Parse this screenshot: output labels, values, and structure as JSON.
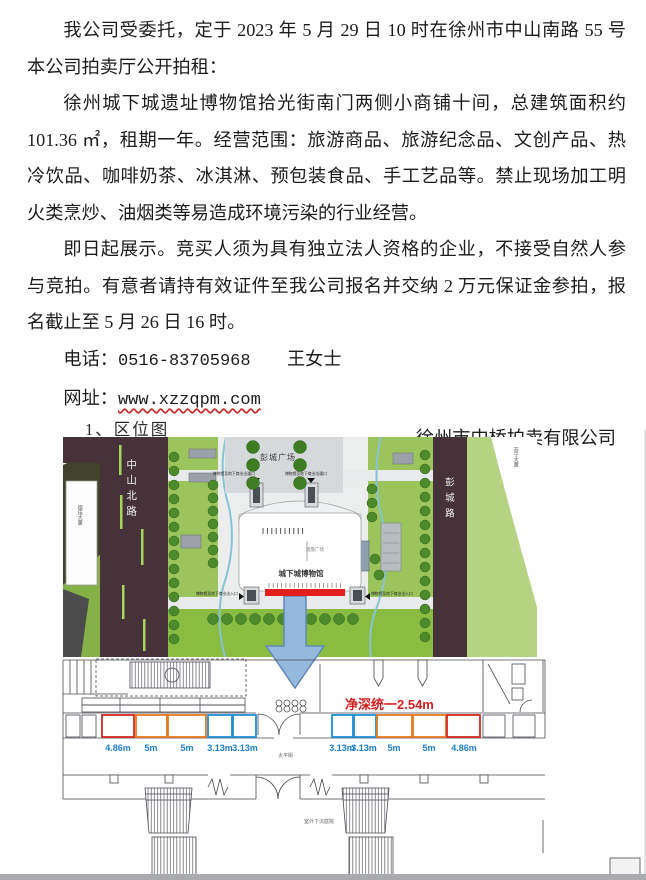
{
  "document": {
    "p1": [
      "我公司受委托，定于 2023 年 5 月 29 日 10 时在徐州市中山南路 55 号",
      "本公司拍卖厅公开拍租："
    ],
    "p2": [
      "徐州城下城遗址博物馆拾光街南门两侧小商铺十间，总建筑面积约",
      "101.36 ㎡，租期一年。经营范围：旅游商品、旅游纪念品、文创产品、热",
      "冷饮品、咖啡奶茶、冰淇淋、预包装食品、手工艺品等。禁止现场加工明",
      "火类烹炒、油烟类等易造成环境污染的行业经营。"
    ],
    "p3": [
      "即日起展示。竞买人须为具有独立法人资格的企业，不接受自然人参",
      "与竞拍。有意者请持有效证件至我公司报名并交纳 2 万元保证金参拍，报",
      "名截止至 5 月 26 日 16 时。"
    ],
    "phone_label": "电话：",
    "phone_number": "0516-83705968",
    "contact_name": "王女士",
    "website_label": "网址：",
    "website_url": "www.xzzqpm.com",
    "signature": "徐州市中桥拍卖有限公司",
    "figure_caption": "1、区位图"
  },
  "site_map": {
    "labels": {
      "road_left": "中山北路",
      "road_right": "彭城路",
      "square": "彭城广场",
      "museum": "城下城博物馆",
      "viewing_plaza": "观景广场",
      "building_left": "德佳大厦",
      "building_top_right": "苏宁大厦",
      "entrance_top_left": "博物馆及地下商业出通口",
      "entrance_top_right": "博物馆及地下商业出通口",
      "entrance_left": "博物馆及地下商业出入口",
      "entrance_right": "博物馆及地下商业出入口"
    }
  },
  "floor_plan": {
    "depth_note": "净深统一2.54m",
    "dims_left": [
      "4.86m",
      "5m",
      "5m",
      "3.13m",
      "3.13m"
    ],
    "dims_right": [
      "3.13m",
      "3.13m",
      "5m",
      "5m",
      "4.86m"
    ],
    "street_label": "太平街",
    "courtyard_label": "室外下沉庭院"
  },
  "colors": {
    "unit_red": "#d42a22",
    "unit_orange": "#e8791f",
    "unit_blue": "#1e8fd5",
    "dimension_text": "#1b7fd4",
    "depth_note_text": "#d42020",
    "highlight_strip": "#e31e1e",
    "arrow_blue": "#95b8dd",
    "road_dark": "#46333a",
    "grass_green": "#9cc45c",
    "url_underline": "#cc2a2a"
  }
}
